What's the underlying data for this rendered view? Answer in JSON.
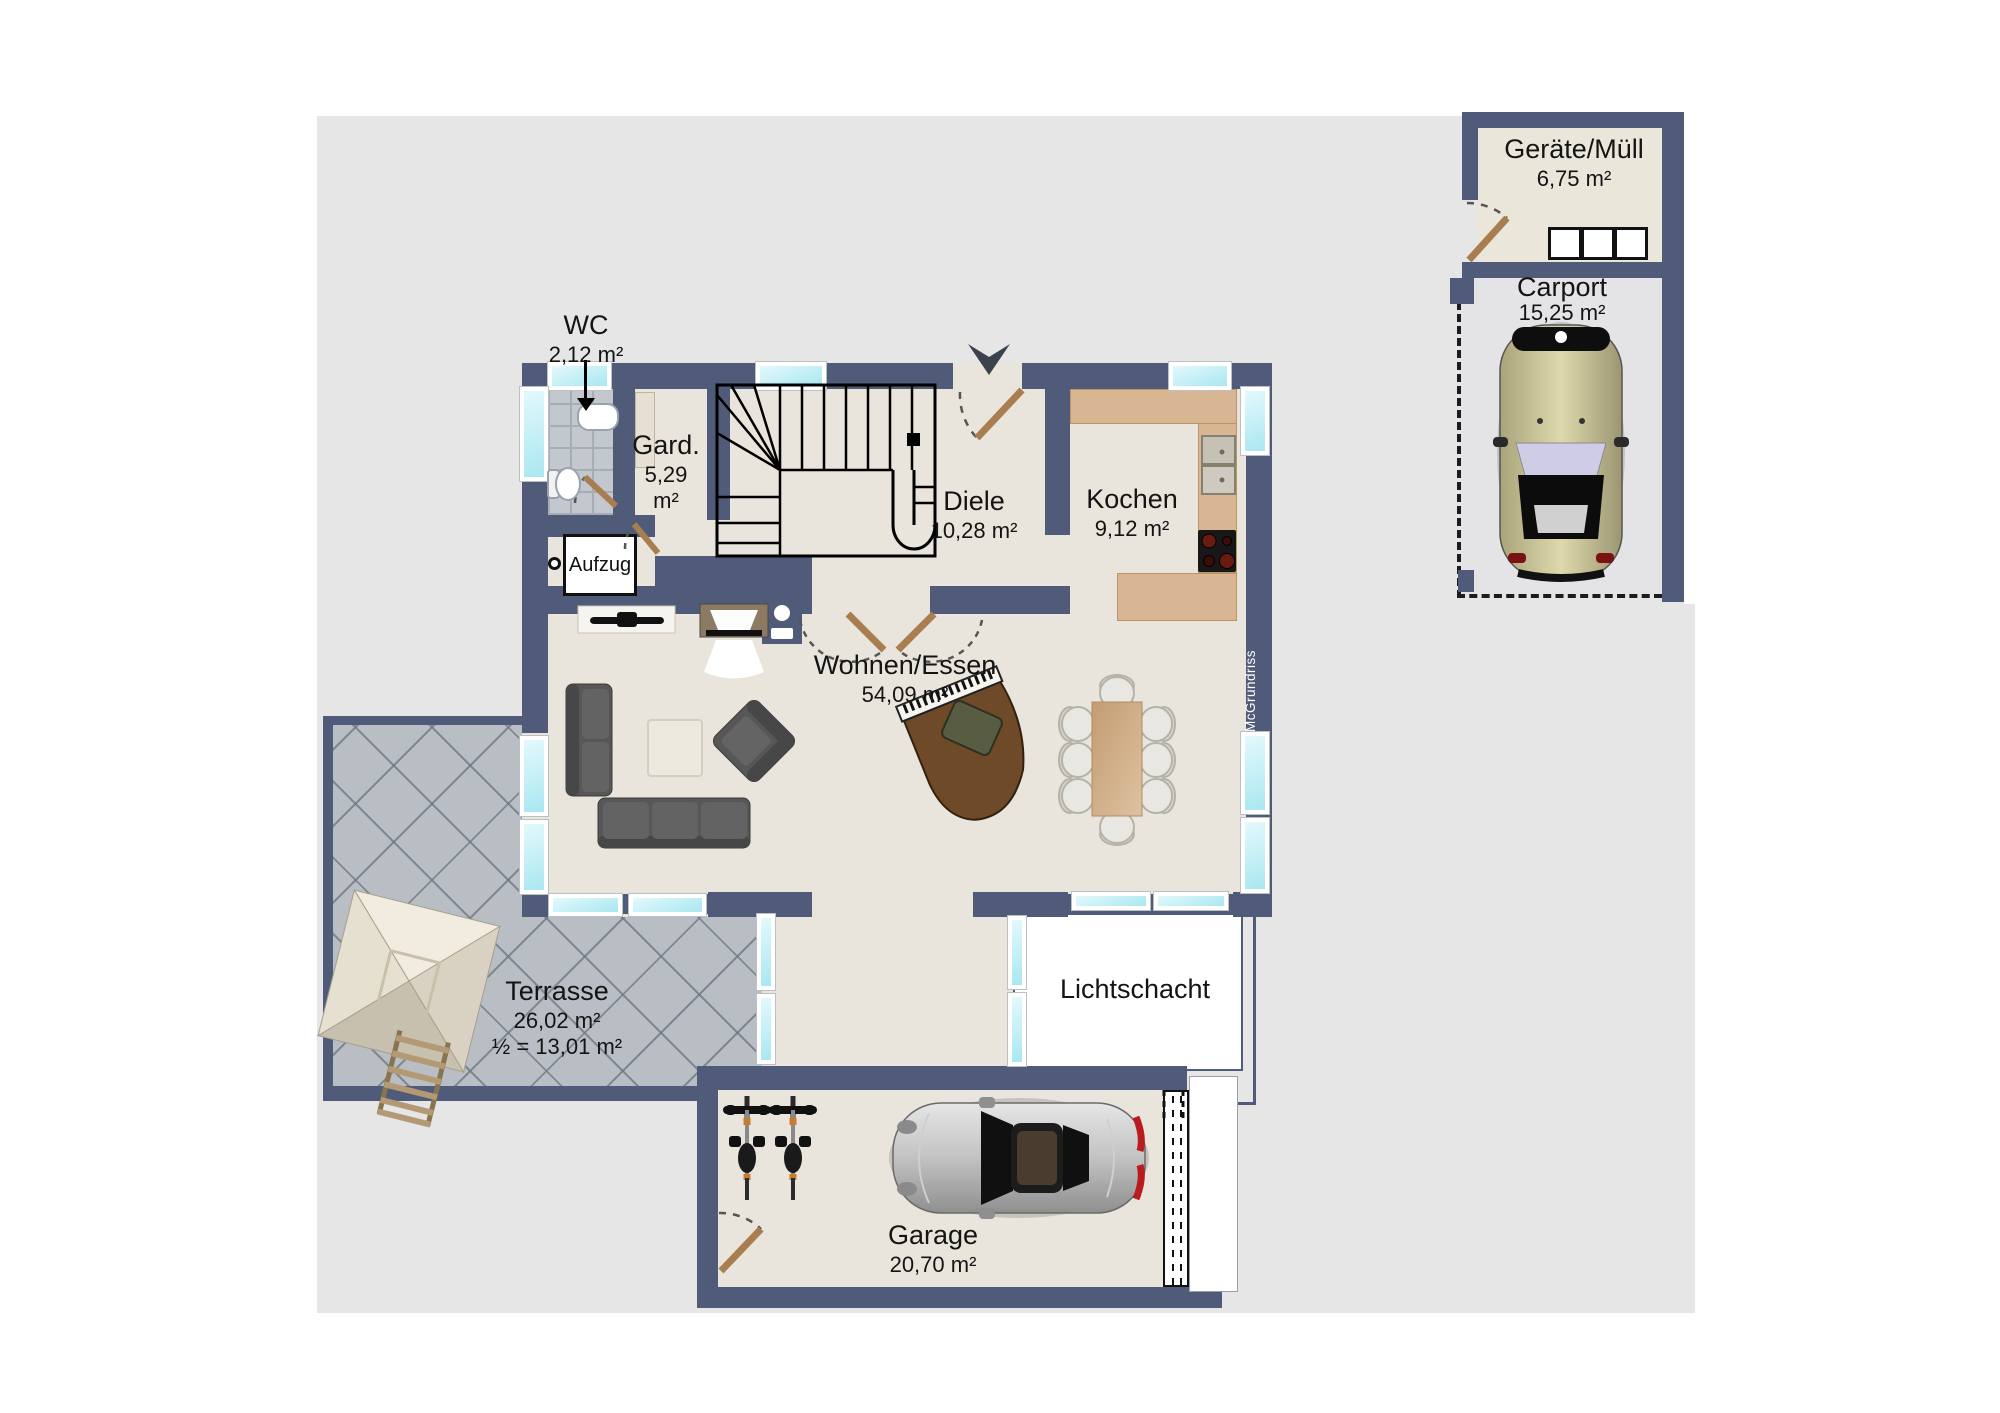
{
  "plan_title": "Erdgeschoss Grundriss",
  "colors": {
    "wall": "#505b7a",
    "floor": "#e9e5dc",
    "window_glass": "#bfeef5",
    "kitchen_counter": "#d8b694",
    "terrace_tile": "#b9bec5",
    "door_leaf": "#a87e50",
    "background": "#e6e6e6"
  },
  "rooms": {
    "wc": {
      "name": "WC",
      "area": "2,12 m²"
    },
    "gard": {
      "name": "Gard.",
      "area_value": "5,29",
      "area_unit": "m²"
    },
    "diele": {
      "name": "Diele",
      "area": "10,28 m²"
    },
    "kochen": {
      "name": "Kochen",
      "area": "9,12 m²"
    },
    "wohnen_essen": {
      "name": "Wohnen/Essen",
      "area": "54,09 m²"
    },
    "aufzug": {
      "name": "Aufzug"
    },
    "terrasse": {
      "name": "Terrasse",
      "area": "26,02 m²",
      "area_half": "½ = 13,01 m²"
    },
    "lichtschacht": {
      "name": "Lichtschacht"
    },
    "garage": {
      "name": "Garage",
      "area": "20,70 m²"
    },
    "geraete_muell": {
      "name": "Geräte/Müll",
      "area": "6,75 m²"
    },
    "carport": {
      "name": "Carport",
      "area": "15,25 m²"
    }
  },
  "watermark": {
    "text": "McGrundriss"
  },
  "icons": {
    "entrance_arrow": "entrance-direction-arrow",
    "stairs": "staircase-with-winder",
    "elevator": "elevator-shaft"
  }
}
